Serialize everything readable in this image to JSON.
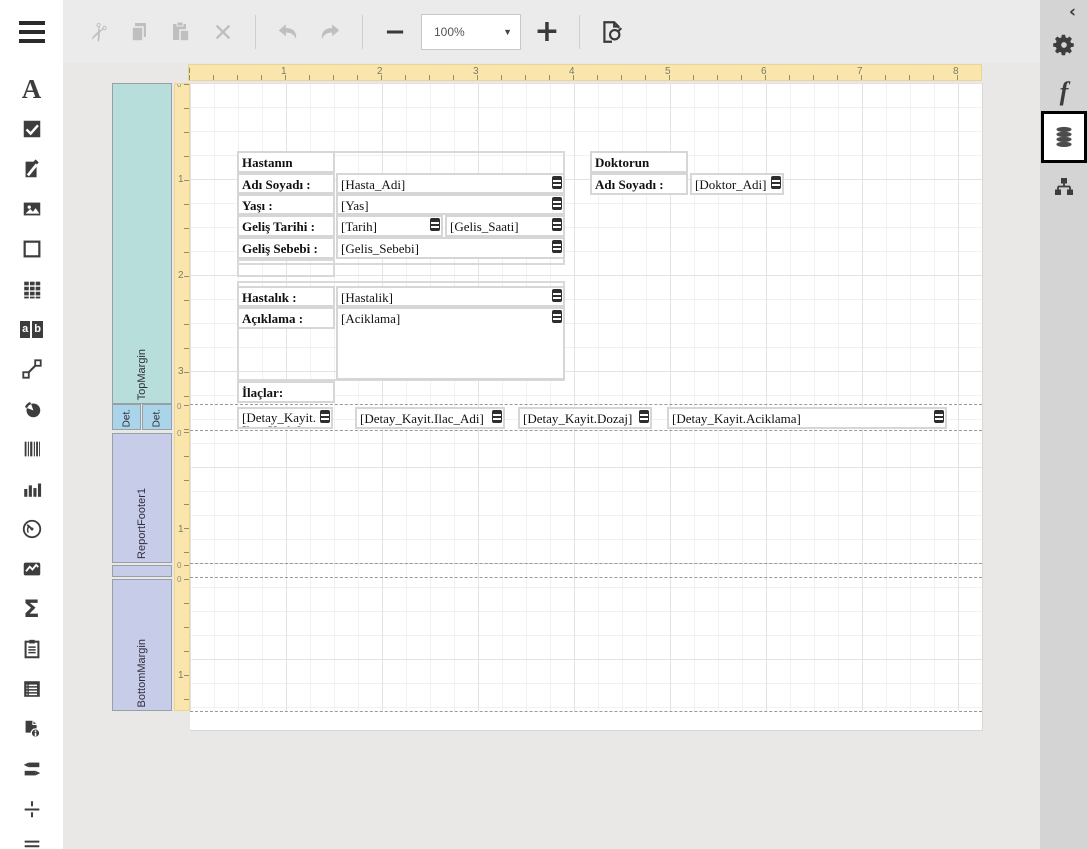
{
  "toolbar": {
    "zoom_value": "100%",
    "buttons": [
      "menu",
      "cut",
      "copy",
      "paste",
      "delete",
      "undo",
      "redo",
      "zoom-out",
      "zoom-select",
      "zoom-in",
      "preview"
    ]
  },
  "left_toolbox": {
    "items": [
      "label",
      "check-box",
      "rich-text",
      "picture-box",
      "panel",
      "table",
      "character-comb",
      "line",
      "shape",
      "barcode",
      "chart",
      "gauge",
      "sparkline",
      "summary",
      "clipboard",
      "table-of-contents",
      "subreport",
      "page-break",
      "cross-band-line",
      "cross-band-box"
    ],
    "label_glyph": "A",
    "sigma_glyph": "Σ"
  },
  "right_sidebar": {
    "icons": [
      "collapse-chevron",
      "properties-gear",
      "expression-f",
      "field-list-database",
      "report-explorer-tree"
    ],
    "selected": "field-list-database",
    "chevron_glyph": "‹",
    "f_glyph": "f"
  },
  "rulers": {
    "zero": "0",
    "horizontal": [
      "1",
      "2",
      "3",
      "4",
      "5",
      "6",
      "7",
      "8"
    ],
    "vertical": {
      "top_margin": [
        "1",
        "2",
        "3"
      ],
      "report_footer": [
        "1"
      ],
      "bottom_margin": [
        "1"
      ]
    }
  },
  "bands": {
    "top_margin": "TopMargin",
    "detail_report": "Det.",
    "detail": "Det.",
    "report_footer": "ReportFooter1",
    "bottom_margin": "BottomMargin"
  },
  "report": {
    "patient": {
      "header": "Hastanın",
      "rows": [
        {
          "label": "Adı Soyadı :",
          "field": "[Hasta_Adi]"
        },
        {
          "label": "Yaşı :",
          "field": "[Yas]"
        },
        {
          "label": "Geliş Tarihi :",
          "field": "[Tarih]",
          "field2": "[Gelis_Saati]"
        },
        {
          "label": "Geliş Sebebi :",
          "field": "[Gelis_Sebebi]"
        }
      ],
      "illness_label": "Hastalık :",
      "illness_field": "[Hastalik]",
      "desc_label": "Açıklama :",
      "desc_field": "[Aciklama]",
      "drugs_label": "İlaçlar:"
    },
    "doctor": {
      "header": "Doktorun",
      "label": "Adı Soyadı :",
      "field": "[Doktor_Adi]"
    },
    "detail_fields": [
      "[Detay_Kayit.Ilac_Kodu]",
      "[Detay_Kayit.Ilac_Adi]",
      "[Detay_Kayit.Dozaj]",
      "[Detay_Kayit.Aciklama]"
    ]
  },
  "colors": {
    "toolbar_bg": "#ebebeb",
    "ruler": "#fae6ad",
    "band_top_margin": "#b7dedb",
    "band_detail": "#aad4e9",
    "band_footer": "#c7cce9",
    "disabled_icon": "#bfbfbf",
    "icon": "#3d3d3d"
  }
}
